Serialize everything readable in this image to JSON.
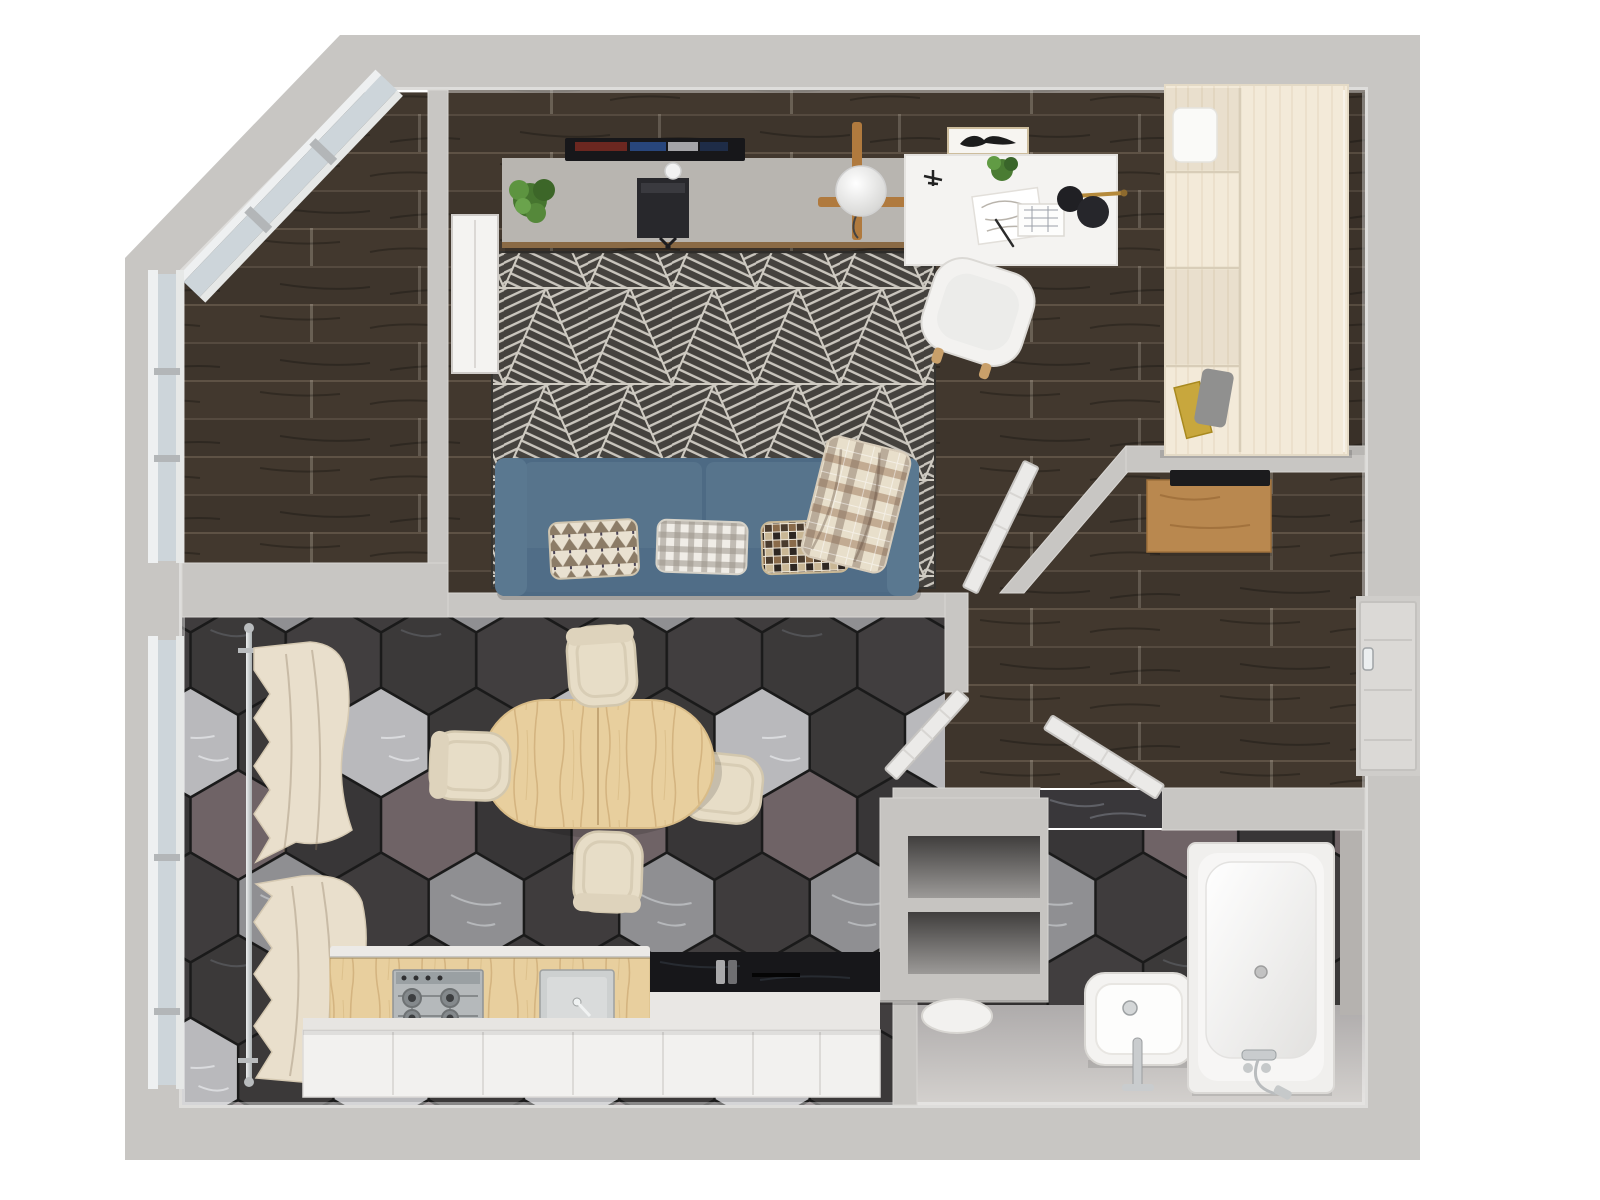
{
  "scene": {
    "description": "3D rendered top-down floor plan of a one-room apartment",
    "view": "top-down",
    "background": "#ffffff"
  },
  "palette": {
    "wall": "#c8c6c3",
    "wall_inner_highlight": "#e9e7e4",
    "wood_floor_dark": "#42382e",
    "rug_base": "#45423e",
    "rug_line": "#c9c5bd",
    "hex_dark": "#3b3939",
    "hex_light": "#b9b9bc",
    "hex_plum": "#6f6366",
    "hex_mid": "#8f8f92",
    "sofa_blue": "#57748c",
    "sofa_blue_dark": "#4d6a84",
    "sofa_back": "#506d87",
    "cream_fabric": "#e9dfcc",
    "light_wood": "#e8cf9e",
    "console_wood": "#b9884f",
    "trim_wood": "#8a6a45",
    "wardrobe_cream": "#f3ead9",
    "tv_console_gray": "#b8b5b0",
    "appliance_black": "#17171a",
    "chrome": "#c9ccce",
    "brass": "#b58a3c",
    "plant_green": "#4e7f38",
    "window_glass": "#cdd5da",
    "window_frame": "#eef0f1",
    "white_fixture": "#f4f3f1",
    "bath_floor": "#b2afac"
  },
  "rooms": [
    {
      "id": "balcony",
      "label": "balcony",
      "floor": "dark-wood-planks",
      "features": [
        "angled-glazed-corner",
        "window-mullions"
      ]
    },
    {
      "id": "living-room",
      "label": "living-room",
      "floor": "dark-wood-planks",
      "features": [
        "triangle-pattern-rug"
      ]
    },
    {
      "id": "study-nook",
      "label": "study-nook",
      "floor": "dark-wood-planks"
    },
    {
      "id": "hallway",
      "label": "hallway",
      "floor": "dark-wood-planks"
    },
    {
      "id": "kitchen-dining",
      "label": "kitchen-dining",
      "floor": "hexagonal-stone-tiles"
    },
    {
      "id": "bathroom",
      "label": "bathroom",
      "floor": "hexagonal-stone-tiles"
    }
  ],
  "furniture": {
    "living_room": [
      "wall-tv",
      "tv-console",
      "potted-plant",
      "av-receiver",
      "webcam-sphere",
      "geometric-rug",
      "three-seat-sofa",
      "pillow-triangle-print",
      "pillow-gingham",
      "pillow-mosaic",
      "plaid-throw-blanket",
      "radiator-panel",
      "globe-floor-lamp"
    ],
    "study_nook": [
      "white-desk",
      "desk-chair",
      "black-desk-lamp",
      "model-airplane",
      "desk-plant",
      "sketch-papers",
      "floor-plan-sheet",
      "pen",
      "wall-art-frame"
    ],
    "hallway": [
      "entry-door",
      "console-table",
      "open-door-living",
      "open-door-kitchen",
      "open-door-bathroom",
      "wardrobe-unit"
    ],
    "kitchen_dining": [
      "oval-dining-table",
      "dining-chair-north",
      "dining-chair-west",
      "dining-chair-south",
      "dining-chair-east",
      "window-curtain-top",
      "window-curtain-bottom",
      "curtain-rod",
      "wood-countertop",
      "gas-hob",
      "kitchen-sink",
      "black-counter",
      "base-cabinets",
      "wall-niche-shelves"
    ],
    "bathroom": [
      "bathtub",
      "tub-shower-mixer",
      "wash-basin",
      "basin-faucet",
      "toilet",
      "marble-threshold"
    ]
  }
}
